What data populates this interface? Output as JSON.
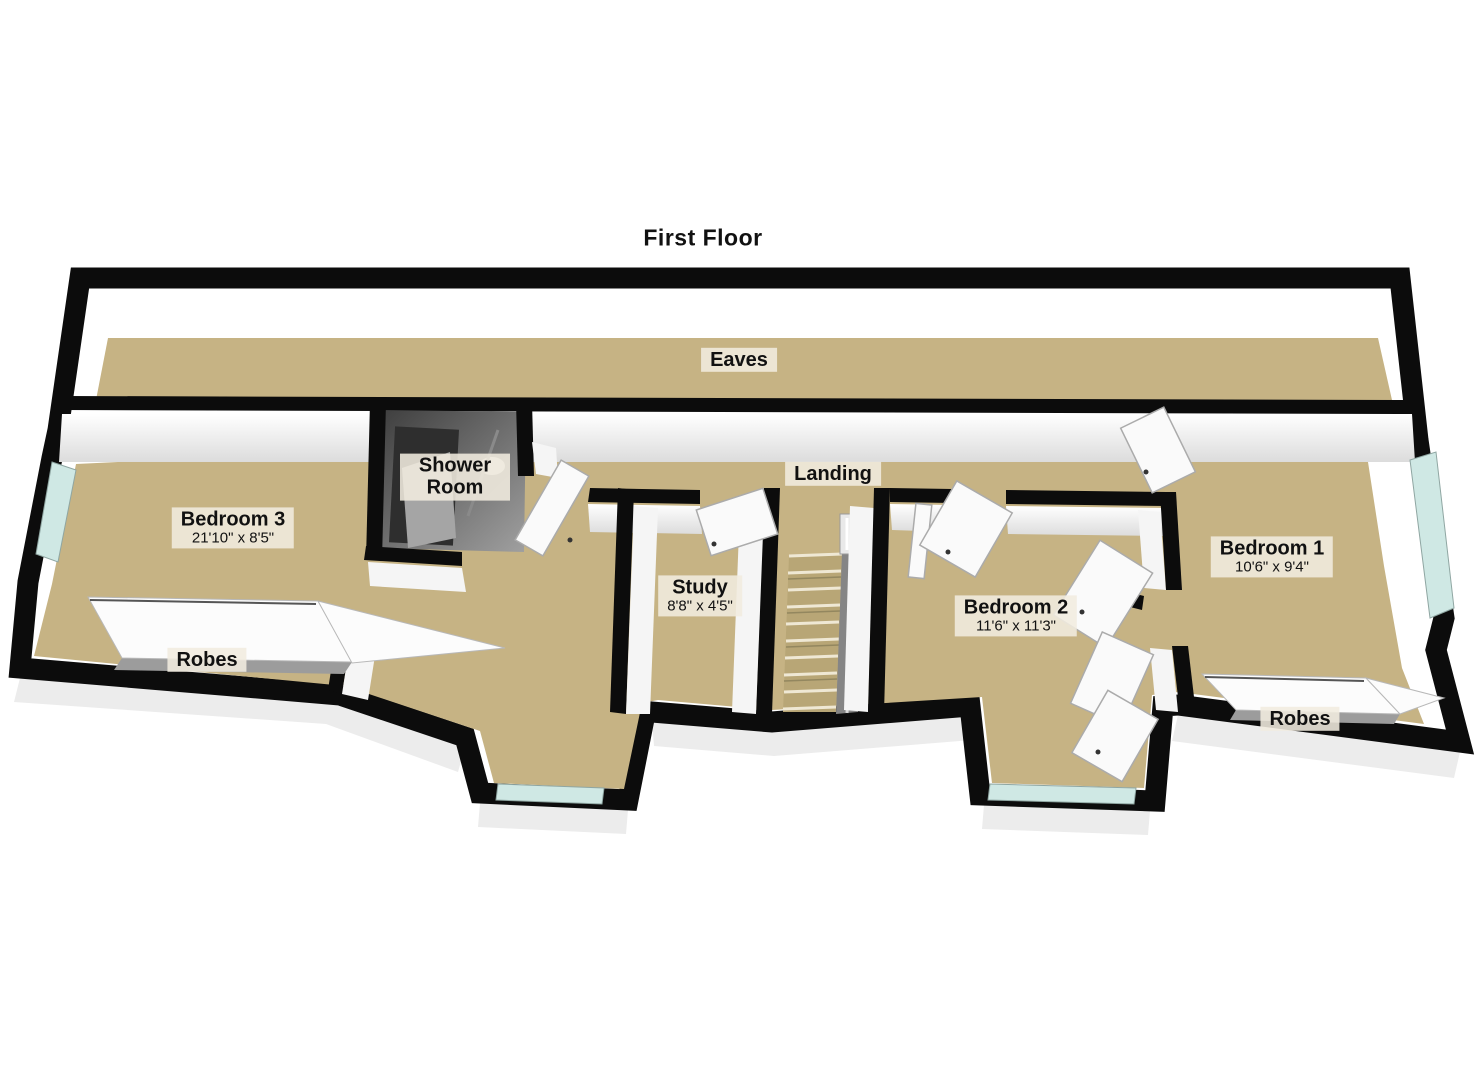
{
  "plan": {
    "floor_label": "First Floor",
    "rooms": [
      {
        "id": "eaves",
        "name": "Eaves",
        "dims": ""
      },
      {
        "id": "bedroom3",
        "name": "Bedroom 3",
        "dims": "21'10\" x 8'5\""
      },
      {
        "id": "robes-left",
        "name": "Robes",
        "dims": ""
      },
      {
        "id": "shower-room",
        "name": "Shower Room",
        "dims": ""
      },
      {
        "id": "study",
        "name": "Study",
        "dims": "8'8\" x 4'5\""
      },
      {
        "id": "landing",
        "name": "Landing",
        "dims": ""
      },
      {
        "id": "bedroom2",
        "name": "Bedroom 2",
        "dims": "11'6\" x 11'3\""
      },
      {
        "id": "bedroom1",
        "name": "Bedroom 1",
        "dims": "10'6\" x 9'4\""
      },
      {
        "id": "robes-right",
        "name": "Robes",
        "dims": ""
      }
    ],
    "features": [
      "stairs",
      "banister",
      "bay-windows",
      "door-leaves",
      "robes-shelves",
      "shower-fixtures"
    ]
  },
  "colors": {
    "background": "#ffffff",
    "wall": "#0c0c0c",
    "wall_face": "#f5f5f5",
    "floor": "#c6b384",
    "floor_dark": "#b8a676",
    "window_glass": "#cfe8e4",
    "banister": "#858585",
    "shower_dark": "#3c3c3c",
    "label_bg": "#f1ecdf",
    "label_text": "#111111"
  }
}
